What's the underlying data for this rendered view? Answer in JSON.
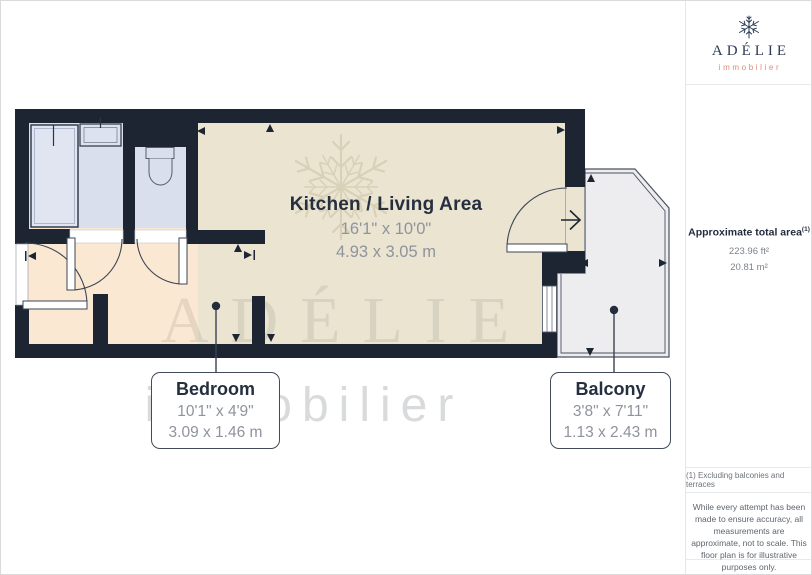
{
  "rooms": {
    "kitchen": {
      "name": "Kitchen / Living Area",
      "imperial": "16'1\" x 10'0\"",
      "metric": "4.93 x 3.05 m"
    },
    "bedroom": {
      "name": "Bedroom",
      "imperial": "10'1\" x 4'9\"",
      "metric": "3.09 x 1.46 m"
    },
    "balcony": {
      "name": "Balcony",
      "imperial": "3'8\" x 7'11\"",
      "metric": "1.13 x 2.43 m"
    }
  },
  "sidebar": {
    "logo": {
      "name": "ADÉLIE",
      "tagline": "immobilier"
    },
    "area": {
      "label": "Approximate total area",
      "superscript": "(1)",
      "imperial": "223.96 ft²",
      "metric": "20.81 m²"
    },
    "footnote": "(1) Excluding balconies and terraces",
    "disclaimer": "While every attempt has been made to ensure accuracy, all measurements are approximate, not to scale. This floor plan is for illustrative purposes only.",
    "provider": {
      "name": "GIRAFFE",
      "suffix": "360"
    }
  },
  "watermark": {
    "name": "ADÉLIE",
    "tagline": "immobilier"
  },
  "colors": {
    "wall": "#1d2533",
    "living_floor": "#eae4d1",
    "bedroom_floor": "#fbe8d2",
    "bathroom_floor": "#d9dfec",
    "balcony_floor": "#ededf0",
    "brand_navy": "#2e3b55",
    "brand_salmon": "#db8a76"
  }
}
